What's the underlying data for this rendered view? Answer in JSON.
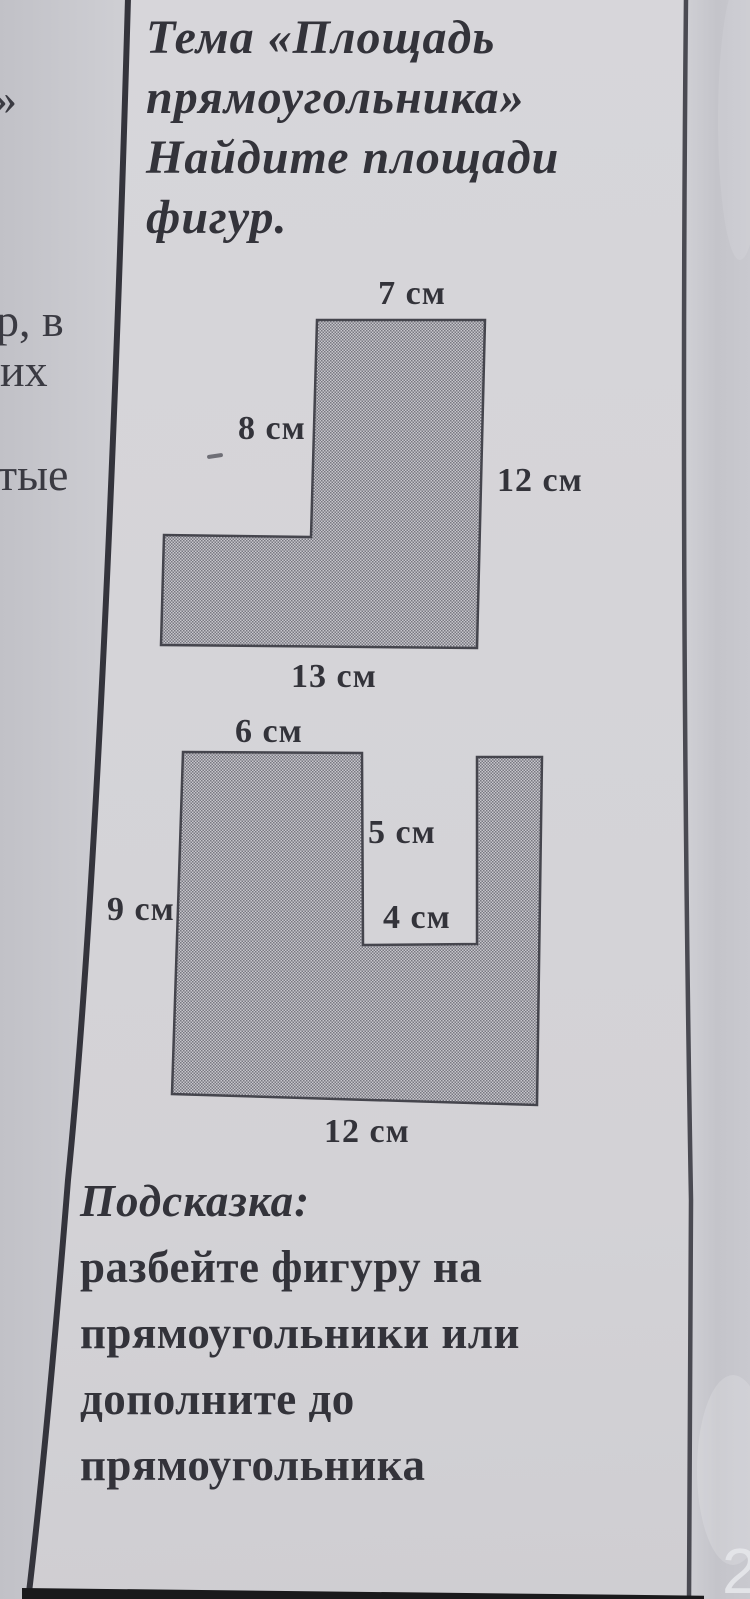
{
  "document": {
    "kind": "math worksheet photo",
    "title_lines": [
      "Тема «Площадь",
      "прямоугольника»",
      "Найдите площади",
      "фигур."
    ],
    "page_number": "2"
  },
  "left_column_fragments": [
    {
      "text": "»"
    },
    {
      "text": "р, в"
    },
    {
      "text": "их"
    },
    {
      "text": "тые"
    }
  ],
  "figures": [
    {
      "shape": "L-shape",
      "labels": {
        "top": "7 см",
        "left": "8 см",
        "right": "12 см",
        "bottom": "13 см"
      },
      "values_cm": {
        "top": 7,
        "left": 8,
        "right": 12,
        "bottom": 13
      }
    },
    {
      "shape": "U-shape",
      "labels": {
        "top": "6 см",
        "notch_depth": "5 см",
        "notch_width": "4 см",
        "left": "9 см",
        "bottom": "12 см"
      },
      "values_cm": {
        "top": 6,
        "notch_depth": 5,
        "notch_width": 4,
        "left": 9,
        "bottom": 12
      }
    }
  ],
  "hint": {
    "heading": "Подсказка:",
    "lines": [
      "разбейте фигуру на",
      "прямоугольники или",
      "дополните до",
      "прямоугольника"
    ]
  },
  "colors": {
    "paper": "#d5d4d8",
    "margin_left_col": "#c9c8ce",
    "margin_right_col": "#c5c4ca",
    "figure_dot": "#787881",
    "figure_base": "#c7c6cc",
    "outline": "#45454d",
    "text": "#33333a",
    "band": "#1a1a1c",
    "page_num": "#e3e4e8"
  }
}
